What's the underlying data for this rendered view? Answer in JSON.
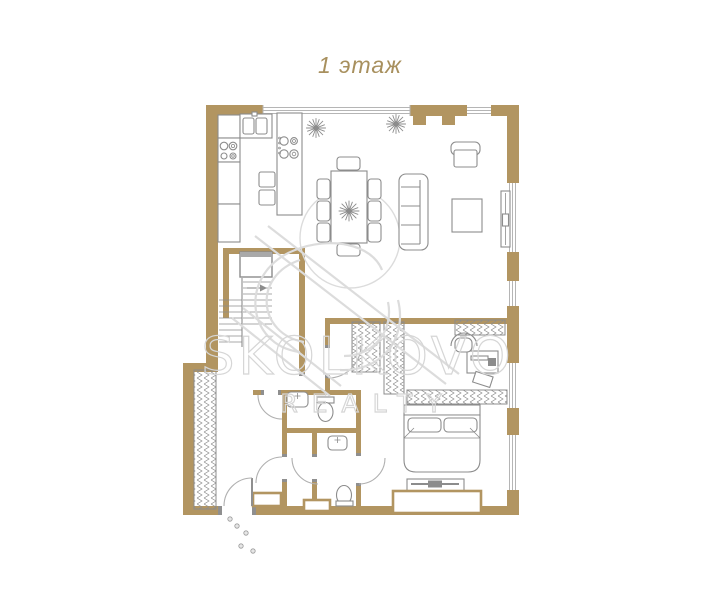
{
  "title": "1 этаж",
  "watermark": {
    "brand": "SKOLKOVO",
    "tagline": "REALTY"
  },
  "colors": {
    "background": "#ffffff",
    "wall": "#b29561",
    "line": "#8c8c8c",
    "watermark": "#dcdcdc",
    "title": "#a8905e"
  }
}
